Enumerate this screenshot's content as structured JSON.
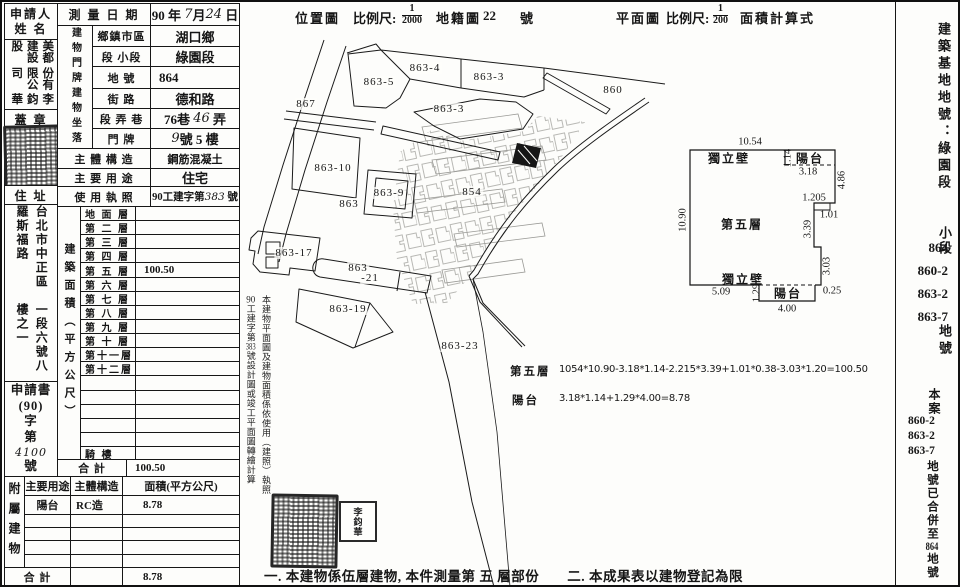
{
  "header": {
    "location_map": "位置圖",
    "scale_label1": "比例尺:",
    "scale1_num": "1",
    "scale1_den": "2000",
    "cadastral_map": "地籍圖",
    "sheet_no": "22",
    "sheet_unit": "號",
    "floor_plan": "平面圖",
    "scale_label2": "比例尺:",
    "scale2_num": "1",
    "scale2_den": "200",
    "area_calc": "面積計算式"
  },
  "table": {
    "applicant_label1": "申請人",
    "applicant_label2": "姓 名",
    "applicant_cols": [
      "美都建設股",
      "份有限公司",
      "李鈞華"
    ],
    "seal_label": "蓋 章",
    "address_label": "住 址",
    "address_cols": [
      "台北市中正區羅斯福路",
      "一段六號八樓之一"
    ],
    "app_title": "申請書",
    "app_l1": "(90)",
    "app_l2": "字",
    "app_l3": "第",
    "app_no": "4100",
    "app_l4": "號",
    "survey_label": "測 量 日 期",
    "survey_year": "90 年",
    "survey_month": "7",
    "survey_month_u": "月",
    "survey_day": "24",
    "survey_day_u": "日",
    "plate_col": "建物門牌",
    "site_col": "建物坐落",
    "row_township_label": "鄉鎮市區",
    "row_township_value": "湖口鄉",
    "row_section_label": "段 小段",
    "row_section_value": "綠園段",
    "row_parcel_label": "地 號",
    "row_parcel_value": "864",
    "row_street_label": "街 路",
    "row_street_value": "德和路",
    "row_lane_label": "段 弄 巷",
    "row_lane_pre": "76巷",
    "row_lane_hand": "46",
    "row_lane_suf": "弄",
    "row_door_label": "門 牌",
    "row_door_hand": "9",
    "row_door_rest": "號 5 樓",
    "row_structure_label": "主 體 構 造",
    "row_structure_value": "鋼筋混凝土",
    "row_usage_label": "主 要 用 途",
    "row_usage_value": "住宅",
    "row_permit_label": "使 用 執 照",
    "row_permit_pre": "90工建字第",
    "row_permit_hand": "383",
    "row_permit_suf": "號",
    "floor_area_label": "建築面積（平方公尺）",
    "floors": [
      {
        "label": "地 面 層",
        "value": ""
      },
      {
        "label": "第 二 層",
        "value": ""
      },
      {
        "label": "第 三 層",
        "value": ""
      },
      {
        "label": "第 四 層",
        "value": ""
      },
      {
        "label": "第 五 層",
        "value": "100.50"
      },
      {
        "label": "第 六 層",
        "value": ""
      },
      {
        "label": "第 七 層",
        "value": ""
      },
      {
        "label": "第 八 層",
        "value": ""
      },
      {
        "label": "第 九 層",
        "value": ""
      },
      {
        "label": "第 十 層",
        "value": ""
      },
      {
        "label": "第十一層",
        "value": ""
      },
      {
        "label": "第十二層",
        "value": ""
      },
      {
        "label": "",
        "value": ""
      },
      {
        "label": "",
        "value": ""
      },
      {
        "label": "",
        "value": ""
      },
      {
        "label": "",
        "value": ""
      },
      {
        "label": "",
        "value": ""
      },
      {
        "label": "騎 樓",
        "value": ""
      }
    ],
    "total_label": "合 計",
    "total_value": "100.50",
    "annex_label": "附屬建物",
    "annex_h1": "主要用途",
    "annex_h2": "主體構造",
    "annex_h3": "面積(平方公尺)",
    "annex_r1c1": "陽台",
    "annex_r1c2": "RC造",
    "annex_r1c3": "8.78",
    "annex_total_label": "合 計",
    "annex_total_value": "8.78"
  },
  "side_note": {
    "right": "本建物平面圖及建物面積係依使用（建照）執照",
    "l1": "90",
    "l2": "工建字第",
    "l3": "383",
    "l4": "號設計圖或竣工平面圖轉繪計算"
  },
  "map_labels": [
    "863-4",
    "863-5",
    "863-3",
    "863-3",
    "867",
    "860",
    "863-10",
    "863-9",
    "863",
    "854",
    "863-17",
    "863",
    "-21",
    "863-19",
    "863-23"
  ],
  "plan": {
    "dim_top": "10.54",
    "wall_top": "獨立壁",
    "d114": "1.14",
    "balcony_top": "陽台",
    "d318": "3.18",
    "d486": "4.86",
    "dim_left": "10.90",
    "room": "第五層",
    "d1205": "1.205",
    "d101": "1.01",
    "d339": "3.39",
    "d303": "3.03",
    "wall_bottom": "獨立壁",
    "d509": "5.09",
    "d129": "1.29",
    "balcony_bottom": "陽台",
    "d025": "0.25",
    "d400": "4.00"
  },
  "formulas": {
    "f1_label": "第五層",
    "f1": "1054*10.90-3.18*1.14-2.215*3.39+1.01*0.38-3.03*1.20=100.50",
    "f2_label": "陽台",
    "f2": "3.18*1.14+1.29*4.00=8.78"
  },
  "footer_note": "一. 本建物係伍層建物, 本件測量第 五 層部份　　二. 本成果表以建物登記為限",
  "right_col": {
    "title": "建築基地地號：綠園段",
    "sub": "小段",
    "parcels": [
      "864",
      "860-2",
      "863-2",
      "863-7"
    ],
    "unit": "地號",
    "case_head": "本案",
    "case_parcels": [
      "860-2",
      "863-2",
      "863-7"
    ],
    "tail1": "地號已合併至",
    "merged": "864",
    "tail2": "地號"
  },
  "seal_name": "李鈞華"
}
